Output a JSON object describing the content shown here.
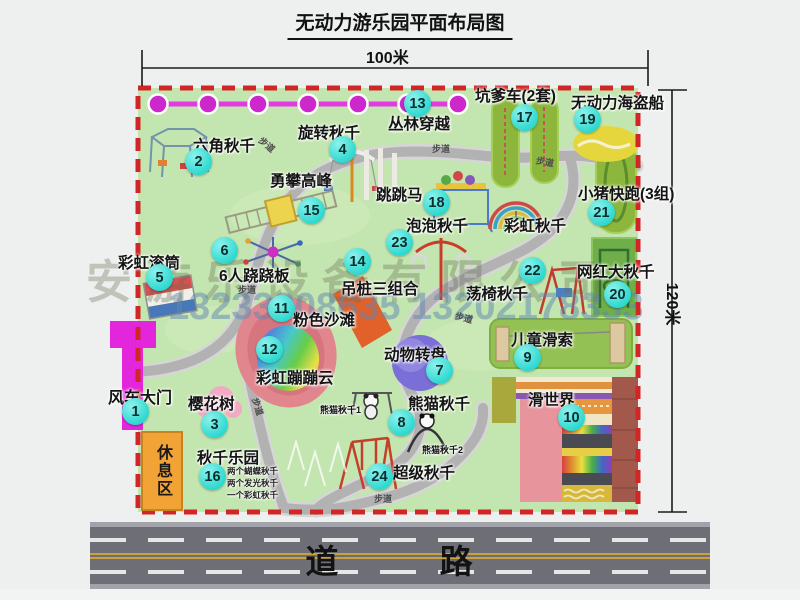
{
  "title": "无动力游乐园平面布局图",
  "dimensions": {
    "width_label": "100米",
    "height_label": "120米"
  },
  "watermark": {
    "company": "安游乐设备有限公司",
    "phone": "13233808635 13202178333"
  },
  "road_label": "道 路",
  "walkway_label": "步道",
  "rest_area_label": "休息区",
  "colors": {
    "badge_teal": "#35dfd6",
    "border_red": "#d22626",
    "park_green": "#c3e5af",
    "chain_magenta": "#cc28cc",
    "road_gray": "#6e6e76"
  },
  "attractions": {
    "a1": {
      "num": "1",
      "label": "风车大门"
    },
    "a2": {
      "num": "2",
      "label": "六角秋千"
    },
    "a3": {
      "num": "3",
      "label": "樱花树"
    },
    "a4": {
      "num": "4",
      "label": "旋转秋千"
    },
    "a5": {
      "num": "5",
      "label": "彩虹滚筒"
    },
    "a6": {
      "num": "6",
      "label": "6人跷跷板"
    },
    "a7": {
      "num": "7",
      "label": "动物转盘"
    },
    "a8": {
      "num": "8",
      "label": "熊猫秋千",
      "sub1": "熊猫秋千1",
      "sub2": "熊猫秋千2"
    },
    "a9": {
      "num": "9",
      "label": "儿童滑索"
    },
    "a10": {
      "num": "10",
      "label": "滑世界"
    },
    "a11": {
      "num": "11",
      "label": "粉色沙滩"
    },
    "a12": {
      "num": "12",
      "label": "彩虹蹦蹦云"
    },
    "a13": {
      "num": "13",
      "label": "丛林穿越"
    },
    "a14": {
      "num": "14",
      "label": "吊桩三组合"
    },
    "a15": {
      "num": "15",
      "label": "勇攀高峰"
    },
    "a16": {
      "num": "16",
      "label": "秋千乐园",
      "notes": [
        "两个蝴蝶秋千",
        "两个发光秋千",
        "一个彩虹秋千"
      ]
    },
    "a17": {
      "num": "17",
      "label": "坑爹车(2套)"
    },
    "a18": {
      "num": "18",
      "label": "跳跳马"
    },
    "a19": {
      "num": "19",
      "label": "无动力海盗船"
    },
    "a20": {
      "num": "20",
      "label": "网红大秋千"
    },
    "a21": {
      "num": "21",
      "label": "小猪快跑(3组)"
    },
    "a22": {
      "num": "22",
      "label": "荡椅秋千"
    },
    "a23": {
      "num": "23",
      "label": "泡泡秋千"
    },
    "a24": {
      "num": "24",
      "label": "超级秋千"
    },
    "rainbow_swing": {
      "label": "彩虹秋千"
    }
  }
}
